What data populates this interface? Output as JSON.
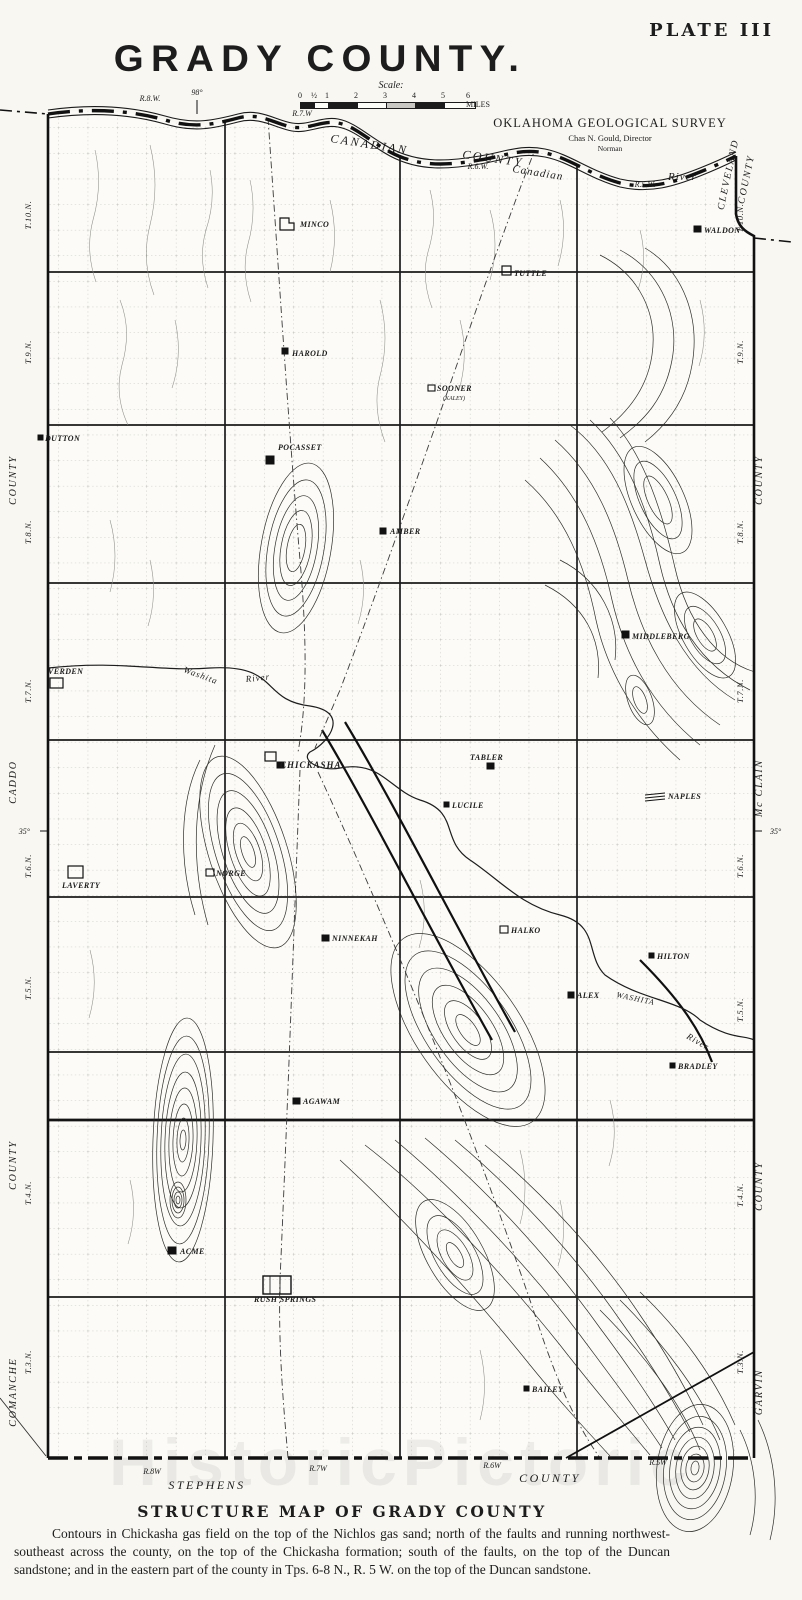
{
  "plate": "PLATE III",
  "title": "GRADY COUNTY.",
  "scale": {
    "label": "Scale:",
    "ticks": [
      "0",
      "½",
      "1",
      "2",
      "3",
      "4",
      "5",
      "6 MILES"
    ]
  },
  "survey": {
    "name": "OKLAHOMA GEOLOGICAL SURVEY",
    "director": "Chas N. Gould, Director",
    "city": "Norman"
  },
  "coords": {
    "meridian": "98°",
    "latitude": "35°"
  },
  "ranges": {
    "top": [
      "R.8.W.",
      "R.7.W",
      "R.6.W.",
      "R.5.W."
    ],
    "bottom": [
      "R.8W",
      "R.7W",
      "R.6W",
      "R.5W"
    ]
  },
  "townships": [
    "T.10.N.",
    "T.9.N.",
    "T.8.N.",
    "T.7.N.",
    "T.6.N.",
    "T.5.N.",
    "T.4.N.",
    "T.3.N."
  ],
  "counties": {
    "top_a": "CANADIAN",
    "top_b": "COUNTY",
    "ne_a": "CLEVELAND",
    "ne_b": "COUNTY",
    "west_upper": "COUNTY",
    "west_mid": "CADDO",
    "west_lower": "COUNTY",
    "west_bottom": "COMANCHE",
    "east_upper": "COUNTY",
    "east_mid": "Mc CLAIN",
    "east_lower": "COUNTY",
    "east_bottom": "GARVIN",
    "south_a": "STEPHENS",
    "south_b": "COUNTY"
  },
  "rivers": {
    "canadian_caps": "CANADIAN",
    "canadian_script": "Canadian",
    "river": "River",
    "washita": "Washita",
    "washita_caps": "WASHITA"
  },
  "towns": [
    {
      "name": "MINCO"
    },
    {
      "name": "WALDON"
    },
    {
      "name": "TUTTLE"
    },
    {
      "name": "HAROLD"
    },
    {
      "name": "SOONER",
      "note": "(KALEY)"
    },
    {
      "name": "DUTTON"
    },
    {
      "name": "POCASSET"
    },
    {
      "name": "AMBER"
    },
    {
      "name": "MIDDLEBERG"
    },
    {
      "name": "VERDEN"
    },
    {
      "name": "CHICKASHA"
    },
    {
      "name": "TABLER"
    },
    {
      "name": "NAPLES"
    },
    {
      "name": "LUCILE"
    },
    {
      "name": "LAVERTY"
    },
    {
      "name": "NORGE"
    },
    {
      "name": "NINNEKAH"
    },
    {
      "name": "HALKO"
    },
    {
      "name": "HILTON"
    },
    {
      "name": "ALEX"
    },
    {
      "name": "AGAWAM"
    },
    {
      "name": "BRADLEY"
    },
    {
      "name": "ACME"
    },
    {
      "name": "RUSH SPRINGS"
    },
    {
      "name": "BAILEY"
    }
  ],
  "caption": {
    "heading": "STRUCTURE MAP OF GRADY COUNTY",
    "body": "Contours in Chickasha gas field on the top of the Nichlos gas sand; north of the faults and running northwest-southeast across the county, on the top of the Chickasha formation; south of the faults, on the top of the Duncan sandstone; and in the eastern part of the county in Tps. 6-8 N., R. 5 W. on the top of the Duncan sandstone."
  },
  "watermark": "HistoricPictoric"
}
